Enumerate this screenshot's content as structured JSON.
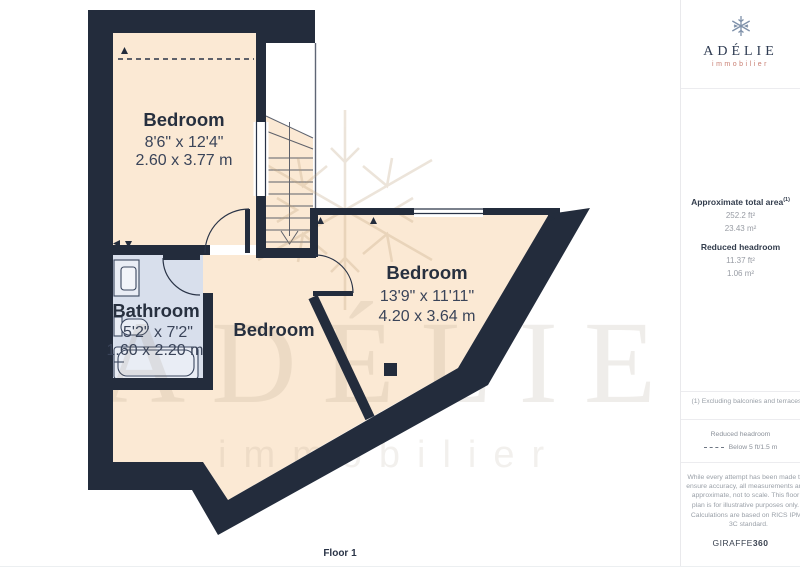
{
  "colors": {
    "wall": "#232C3C",
    "room_fill": "#FBE9D4",
    "bathroom_fill": "#D8DFEC",
    "accent_red": "#C97F73",
    "navy_text": "#27303F"
  },
  "plan": {
    "floor_label": "Floor 1",
    "rooms": [
      {
        "id": "bedroom-top",
        "name": "Bedroom",
        "dimensions_imperial": "8'6\" x 12'4\"",
        "dimensions_metric": "2.60 x 3.77 m"
      },
      {
        "id": "bathroom",
        "name": "Bathroom",
        "dimensions_imperial": "5'2\" x 7'2\"",
        "dimensions_metric": "1.60 x 2.20 m"
      },
      {
        "id": "bedroom-middle",
        "name": "Bedroom"
      },
      {
        "id": "bedroom-right",
        "name": "Bedroom",
        "dimensions_imperial": "13'9\" x 11'11\"",
        "dimensions_metric": "4.20 x 3.64 m"
      }
    ],
    "watermark": {
      "name": "ADÉLIE",
      "tagline": "immobilier",
      "icon": "snowflake"
    }
  },
  "sidebar": {
    "logo": {
      "icon": "snowflake",
      "name": "ADÉLIE",
      "tagline": "immobilier"
    },
    "area": {
      "title": "Approximate total area",
      "footnote_ref": "(1)",
      "values": [
        "252.2 ft²",
        "23.43 m²"
      ]
    },
    "headroom": {
      "title": "Reduced headroom",
      "values": [
        "11.37 ft²",
        "1.06 m²"
      ]
    },
    "footnote": "(1) Excluding balconies and terraces",
    "legend": {
      "title": "Reduced headroom",
      "swatch": "dashed-line",
      "label": "Below 5 ft/1.5 m"
    },
    "disclaimer": "While every attempt has been made to ensure accuracy, all measurements are approximate, not to scale. This floor plan is for illustrative purposes only.",
    "standard": "Calculations are based on RICS IPMS 3C standard.",
    "brand": {
      "name": "GIRAFFE",
      "suffix": "360"
    }
  }
}
